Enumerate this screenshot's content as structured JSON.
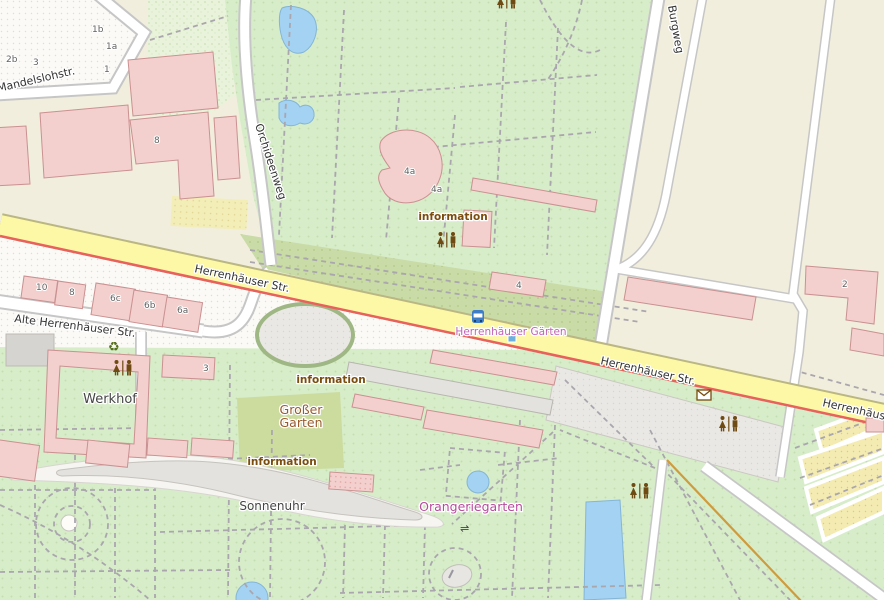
{
  "map": {
    "streets": {
      "mandelslohstr": "Mandelslohstr.",
      "orchideenweg": "Orchideenweg",
      "herrenhaeuser_str_1": "Herrenhäuser Str.",
      "herrenhaeuser_str_2": "Herrenhäuser Str.",
      "herrenhaeuser_str_3": "Herrenhäuser",
      "alte_herrenhaeuser_str": "Alte Herrenhäuser Str.",
      "burgweg": "Burgweg"
    },
    "places": {
      "grosser_garten_line1": "Großer",
      "grosser_garten_line2": "Garten",
      "orangeriegarten": "Orangeriegarten",
      "sonnenuhr": "Sonnenuhr",
      "werkhof": "Werkhof"
    },
    "tram_stop": {
      "name": "Herrenhäuser Gärten"
    },
    "poi_labels": {
      "information_1": "information",
      "information_2": "information",
      "information_3": "information"
    },
    "house_numbers": {
      "n1b": "1b",
      "n1a": "1a",
      "n2b": "2b",
      "n3_tl": "3",
      "n1": "1",
      "n8_tl": "8",
      "n10": "10",
      "n8_row": "8",
      "n6c": "6c",
      "n6b": "6b",
      "n6a": "6a",
      "n3_werkhof": "3",
      "n4a": "4a",
      "n4a_small": "4a",
      "n4": "4",
      "n2": "2"
    },
    "icons": {
      "recycling_glyph": "♻",
      "weir_glyph": "⇌",
      "toilets": "toilets-icon",
      "bus_stop": "bus-stop-icon",
      "post_box": "post-box-icon"
    },
    "colors": {
      "background_beige": "#f2eedd",
      "park_green": "#d7edc9",
      "hedge_green": "#c9dba6",
      "road_yellow": "#fcf8a6",
      "tram_red": "#e8615c",
      "water_blue": "#a4d2f2",
      "building_pink": "#f3cfcd",
      "building_gray": "#e4e2de",
      "poi_brown": "#7a4c0d",
      "label_magenta": "#b84a9e",
      "stop_magenta": "#c263b8",
      "bridleway_orange": "#cf9b3f"
    }
  }
}
